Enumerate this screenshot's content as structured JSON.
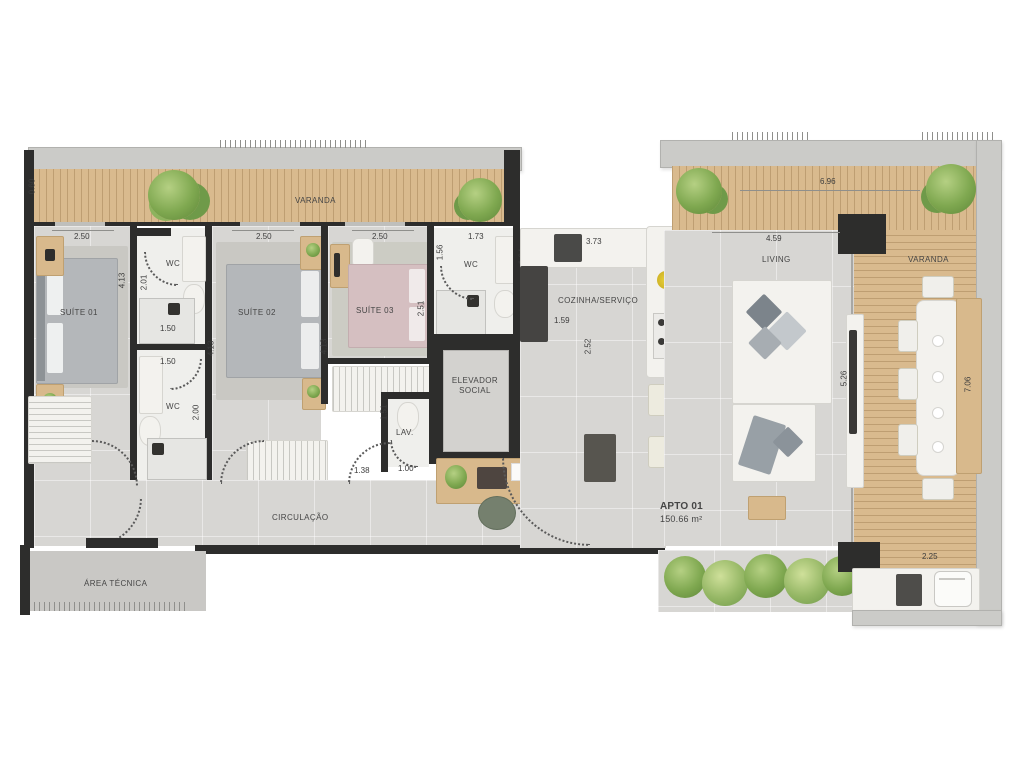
{
  "unit": {
    "name": "APTO 01",
    "area": "150.66 m²"
  },
  "rooms": {
    "varanda_top": "VARANDA",
    "varanda_right": "VARANDA",
    "suite01": "SUÍTE 01",
    "suite02": "SUÍTE 02",
    "suite03": "SUÍTE 03",
    "wc_top": "WC",
    "wc_bottom": "WC",
    "wc_suite03": "WC",
    "cozinha": "COZINHA/SERVIÇO",
    "living": "LIVING",
    "elevador": "ELEVADOR SOCIAL",
    "hall": "HALL PRIVATIVO",
    "lav": "LAV.",
    "circulacao": "CIRCULAÇÃO",
    "area_tecnica": "ÁREA TÉCNICA"
  },
  "dims": {
    "left_wall": "0.60",
    "suite01_w": "2.50",
    "suite01_h": "4.13",
    "wc_top_h": "2.01",
    "wc_top_w": "1.50",
    "wc_bottom_w": "1.50",
    "wc_bottom_h": "2.00",
    "suite02_w": "2.50",
    "suite02_h": "4.13",
    "suite03_wall": "4.13",
    "suite03_w": "2.50",
    "suite03_h": "2.51",
    "wc3_w": "1.73",
    "wc3_h": "1.56",
    "kitchen_left": "1.64",
    "kitchen_w": "3.73",
    "kitchen_inner": "1.59",
    "kitchen_h": "2.52",
    "hall_w": "1.50",
    "hall_h": "1.58",
    "lav_h": "1.51",
    "lav_w": "1.00",
    "corridor_door": "1.38",
    "living_w": "4.59",
    "living_h": "5.26",
    "varanda_top_w": "6.96",
    "varanda_right_h": "7.06",
    "varanda_bottom_w": "2.25"
  },
  "colors": {
    "wall_dark": "#2d2d2c",
    "wall_light": "#cbcbc8",
    "floor": "#d7d6d3",
    "wood_deck": "#d9ba8e",
    "plant_green": "#7fa850"
  }
}
